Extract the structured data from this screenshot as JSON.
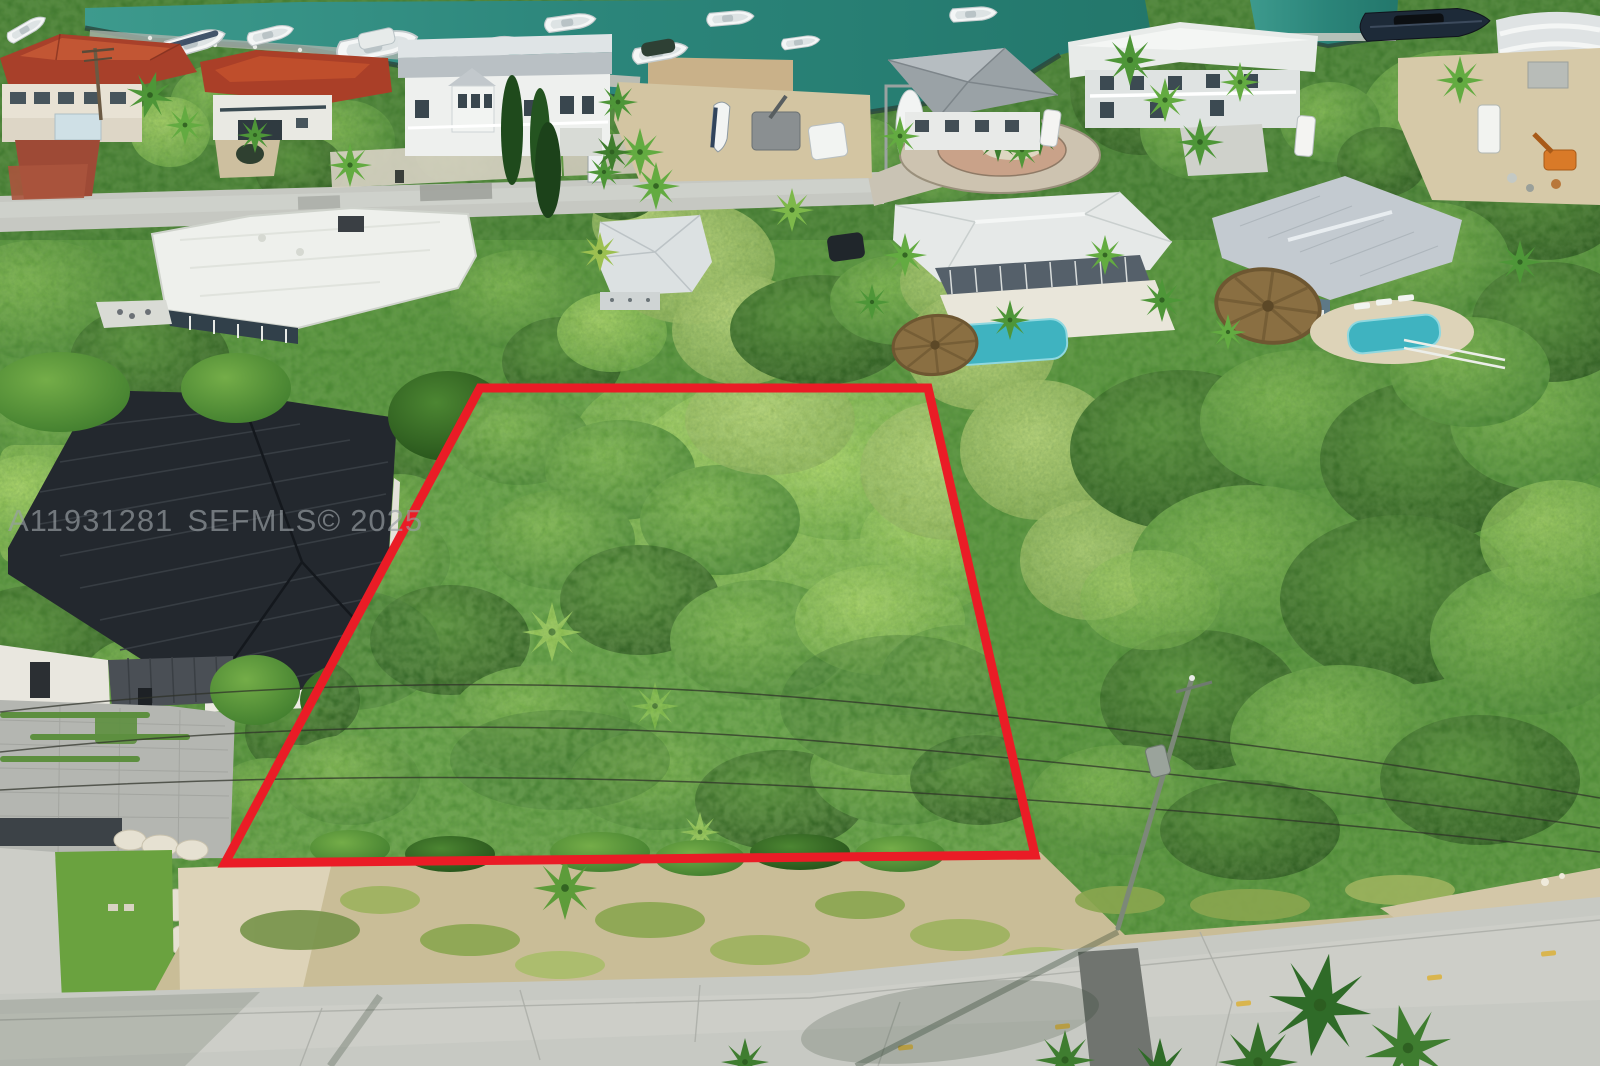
{
  "image": {
    "type": "aerial-drone-photograph",
    "description": "Aerial view of a vacant, densely vegetated residential lot outlined in red, in a Florida Keys waterfront neighborhood with a boat canal, docked boats, houses, pools, tiki huts, overhead power lines and a concrete street in the foreground.",
    "width_px": 1600,
    "height_px": 1066
  },
  "watermark": {
    "listing_id": "A11931281",
    "brand": "SEFMLS©",
    "year": "2025",
    "full_text": "A11931281 SEFMLS© 2025"
  },
  "scene": {
    "subject": "vacant lot outlined in red boundary",
    "features": [
      "canal with docked boats",
      "waterfront homes with metal roofs",
      "swimming pools",
      "tiki huts",
      "paver cul-de-sac",
      "overhead power lines and utility pole",
      "concrete street with yellow reflectors",
      "black standing-seam metal roof house",
      "paver driveway"
    ]
  },
  "colors": {
    "boundary_red": "#ea1c26",
    "water_teal": "#2f8f82",
    "canopy_green": "#4c8a33",
    "lot_green": "#569539",
    "road_gray": "#c7c9c3",
    "sand_tan": "#d6c9a6",
    "dark_roof": "#23282e",
    "terracotta_roof": "#b0462c",
    "pool_teal": "#3fb3c0",
    "thatch_brown": "#8a6f42",
    "watermark_gray": "#9aa0a5"
  }
}
